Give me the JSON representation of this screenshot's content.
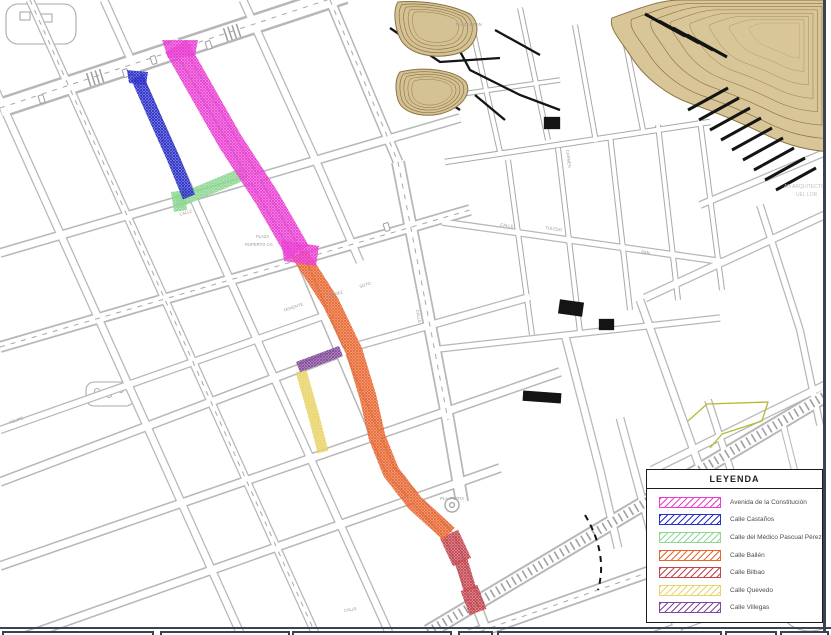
{
  "legend": {
    "title": "LEYENDA",
    "items": [
      {
        "label": "Avenida de la Constitución",
        "color": "#ea3ed2"
      },
      {
        "label": "Calle Castaños",
        "color": "#2a30c8"
      },
      {
        "label": "Calle del Médico Pascual Pérez",
        "color": "#8fd793"
      },
      {
        "label": "Calle Bailén",
        "color": "#e8662f"
      },
      {
        "label": "Calle Bilbao",
        "color": "#c4454f"
      },
      {
        "label": "Calle Quevedo",
        "color": "#e9d469"
      },
      {
        "label": "Calle Villegas",
        "color": "#82489a"
      }
    ]
  },
  "map": {
    "labels": {
      "plaza": "PLAZA",
      "ruperto": "RUPERTO CH.",
      "pla_porta": "PLA. PORTA",
      "plaza_eran": "PLAZA ERAN",
      "teniente": "TENIENTE",
      "alvarez": "ALVAREZ",
      "soto": "SOTO",
      "felipe": "FELIPE",
      "carmen": "CARMEN",
      "toledo": "TOLEDO",
      "san": "SAN",
      "calle_a": "CALLE",
      "calle_b": "CALLE",
      "calle_c": "CALLE",
      "calle_d": "CALLE",
      "wm1": "AN ARQUITECTO",
      "wm2": "UEL LOR"
    }
  },
  "frame": {
    "border_color": "#3d4252"
  }
}
